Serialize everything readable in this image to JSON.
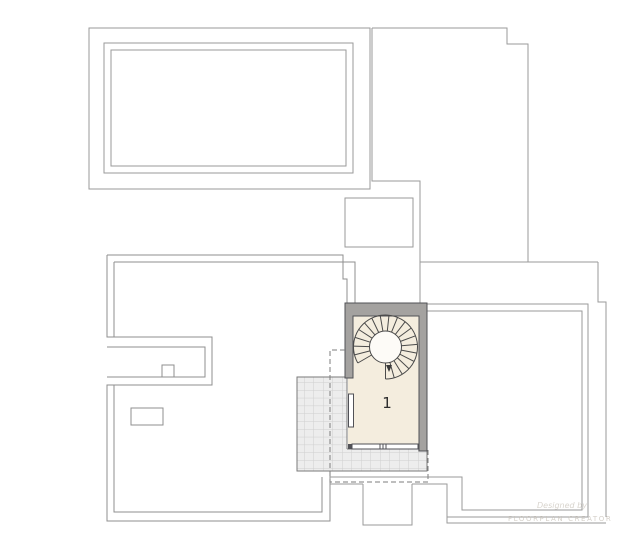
{
  "plan": {
    "room_label": "1",
    "watermark": {
      "line1": "Designed by",
      "line2": "FLOORPLAN CREATOR"
    },
    "colors": {
      "outline": "#9a9a9a",
      "roof_line": "#8f8f8f",
      "wall_fill": "#a4a2a0",
      "wall_stroke": "#515156",
      "floor_cream": "#f4edde",
      "grid_bg": "#ededed",
      "grid_line": "#cfcfcf",
      "grid_border": "#7a7a7a",
      "stair_line": "#4a4a4a",
      "dashed_line": "#7d7d7d",
      "stair_void_fill": "#fdfbf7"
    }
  }
}
